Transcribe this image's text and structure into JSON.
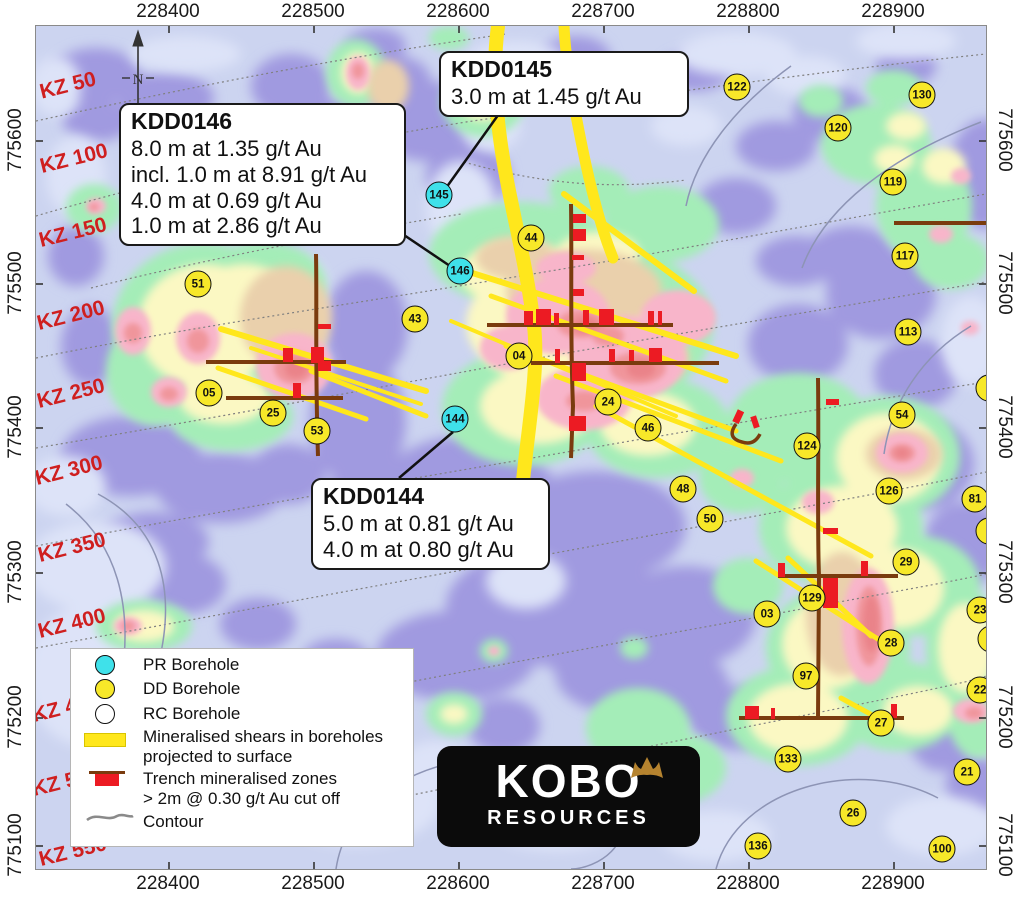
{
  "axes": {
    "x_labels": [
      "228400",
      "228500",
      "228600",
      "228700",
      "228800",
      "228900"
    ],
    "x_positions": [
      168,
      313,
      458,
      603,
      748,
      893
    ],
    "y_labels": [
      "775600",
      "775500",
      "775400",
      "775300",
      "775200",
      "775100"
    ],
    "y_positions": [
      140,
      283,
      427,
      572,
      717,
      845
    ]
  },
  "north": {
    "label": "N"
  },
  "kz_labels": [
    {
      "label": "KZ 50",
      "x": 32,
      "y": 60
    },
    {
      "label": "KZ 100",
      "x": 38,
      "y": 133
    },
    {
      "label": "KZ 150",
      "x": 37,
      "y": 207
    },
    {
      "label": "KZ 200",
      "x": 35,
      "y": 290
    },
    {
      "label": "KZ 250",
      "x": 35,
      "y": 368
    },
    {
      "label": "KZ 300",
      "x": 33,
      "y": 445
    },
    {
      "label": "KZ 350",
      "x": 36,
      "y": 522
    },
    {
      "label": "KZ 400",
      "x": 36,
      "y": 598
    },
    {
      "label": "KZ 450",
      "x": 30,
      "y": 682
    },
    {
      "label": "KZ 500",
      "x": 30,
      "y": 756
    },
    {
      "label": "KZ 550",
      "x": 37,
      "y": 826
    }
  ],
  "callouts": [
    {
      "title": "KDD0146",
      "lines": [
        "8.0 m at 1.35 g/t Au",
        "incl. 1.0 m at 8.91 g/t Au",
        "4.0 m at 0.69 g/t Au",
        "1.0 m at 2.86 g/t Au"
      ],
      "x": 83,
      "y": 77,
      "w": 287
    },
    {
      "title": "KDD0145",
      "lines": [
        "3.0 m at 1.45 g/t Au"
      ],
      "x": 403,
      "y": 25,
      "w": 250
    },
    {
      "title": "KDD0144",
      "lines": [
        "5.0 m at 0.81 g/t Au",
        "4.0 m at 0.80 g/t Au"
      ],
      "x": 275,
      "y": 452,
      "w": 239
    }
  ],
  "boreholes": [
    {
      "label": "145",
      "type": "PR",
      "x": 403,
      "y": 169
    },
    {
      "label": "146",
      "type": "PR",
      "x": 424,
      "y": 245
    },
    {
      "label": "144",
      "type": "PR",
      "x": 419,
      "y": 393
    },
    {
      "label": "122",
      "type": "DD",
      "x": 701,
      "y": 61
    },
    {
      "label": "130",
      "type": "DD",
      "x": 886,
      "y": 69
    },
    {
      "label": "120",
      "type": "DD",
      "x": 802,
      "y": 102
    },
    {
      "label": "119",
      "type": "DD",
      "x": 857,
      "y": 156
    },
    {
      "label": "117",
      "type": "DD",
      "x": 869,
      "y": 230
    },
    {
      "label": "113",
      "type": "DD",
      "x": 872,
      "y": 306
    },
    {
      "label": "51",
      "type": "DD",
      "x": 162,
      "y": 258
    },
    {
      "label": "44",
      "type": "DD",
      "x": 495,
      "y": 212
    },
    {
      "label": "43",
      "type": "DD",
      "x": 379,
      "y": 293
    },
    {
      "label": "04",
      "type": "DD",
      "x": 483,
      "y": 330
    },
    {
      "label": "24",
      "type": "DD",
      "x": 572,
      "y": 376
    },
    {
      "label": "46",
      "type": "DD",
      "x": 612,
      "y": 402
    },
    {
      "label": "54",
      "type": "DD",
      "x": 866,
      "y": 389
    },
    {
      "label": "05",
      "type": "DD",
      "x": 173,
      "y": 367
    },
    {
      "label": "25",
      "type": "DD",
      "x": 237,
      "y": 387
    },
    {
      "label": "53",
      "type": "DD",
      "x": 281,
      "y": 405
    },
    {
      "label": "48",
      "type": "DD",
      "x": 647,
      "y": 463
    },
    {
      "label": "50",
      "type": "DD",
      "x": 674,
      "y": 493
    },
    {
      "label": "124",
      "type": "DD",
      "x": 771,
      "y": 420
    },
    {
      "label": "126",
      "type": "DD",
      "x": 853,
      "y": 465
    },
    {
      "label": "81",
      "type": "DD",
      "x": 939,
      "y": 473
    },
    {
      "label": "29",
      "type": "DD",
      "x": 870,
      "y": 536
    },
    {
      "label": "23",
      "type": "DD",
      "x": 944,
      "y": 584
    },
    {
      "label": "03",
      "type": "DD",
      "x": 731,
      "y": 588
    },
    {
      "label": "129",
      "type": "DD",
      "x": 776,
      "y": 572
    },
    {
      "label": "28",
      "type": "DD",
      "x": 855,
      "y": 617
    },
    {
      "label": "97",
      "type": "DD",
      "x": 770,
      "y": 650
    },
    {
      "label": "22",
      "type": "DD",
      "x": 944,
      "y": 664
    },
    {
      "label": "27",
      "type": "DD",
      "x": 845,
      "y": 697
    },
    {
      "label": "21",
      "type": "DD",
      "x": 931,
      "y": 746
    },
    {
      "label": "133",
      "type": "DD",
      "x": 752,
      "y": 733
    },
    {
      "label": "26",
      "type": "DD",
      "x": 817,
      "y": 787
    },
    {
      "label": "136",
      "type": "DD",
      "x": 722,
      "y": 820
    },
    {
      "label": "100",
      "type": "DD",
      "x": 906,
      "y": 823
    },
    {
      "label": "",
      "type": "DD",
      "x": 953,
      "y": 362
    },
    {
      "label": "",
      "type": "DD",
      "x": 953,
      "y": 505
    },
    {
      "label": "",
      "type": "DD",
      "x": 955,
      "y": 613
    }
  ],
  "legend": {
    "items": [
      {
        "kind": "PR",
        "label": "PR Borehole"
      },
      {
        "kind": "DD",
        "label": "DD Borehole"
      },
      {
        "kind": "RC",
        "label": "RC Borehole"
      },
      {
        "kind": "shear",
        "label": "Mineralised shears in boreholes",
        "label2": "projected to surface"
      },
      {
        "kind": "trench",
        "label": "Trench mineralised zones",
        "label2": "> 2m @ 0.30 g/t Au cut off"
      },
      {
        "kind": "contour",
        "label": "Contour"
      }
    ]
  },
  "logo": {
    "title": "KOBO",
    "subtitle": "RESOURCES"
  },
  "colors": {
    "pr_borehole": "#3fe1ea",
    "dd_borehole": "#f7e829",
    "rc_borehole": "#ffffff",
    "shear_yellow": "#ffe71c",
    "trench_brown": "#7a3b0e",
    "trench_red": "#ec1b23",
    "kz_red": "#cf1f1f",
    "map_base": "#ccd4f0",
    "heat_purple": "#a09ae0",
    "heat_green": "#a4edb8",
    "heat_paleyellow": "#fbf8c3",
    "heat_tan": "#ead0ac",
    "heat_pink": "#f8b5ca",
    "heat_salmon": "#f0959b",
    "heat_red": "#ea8389"
  }
}
